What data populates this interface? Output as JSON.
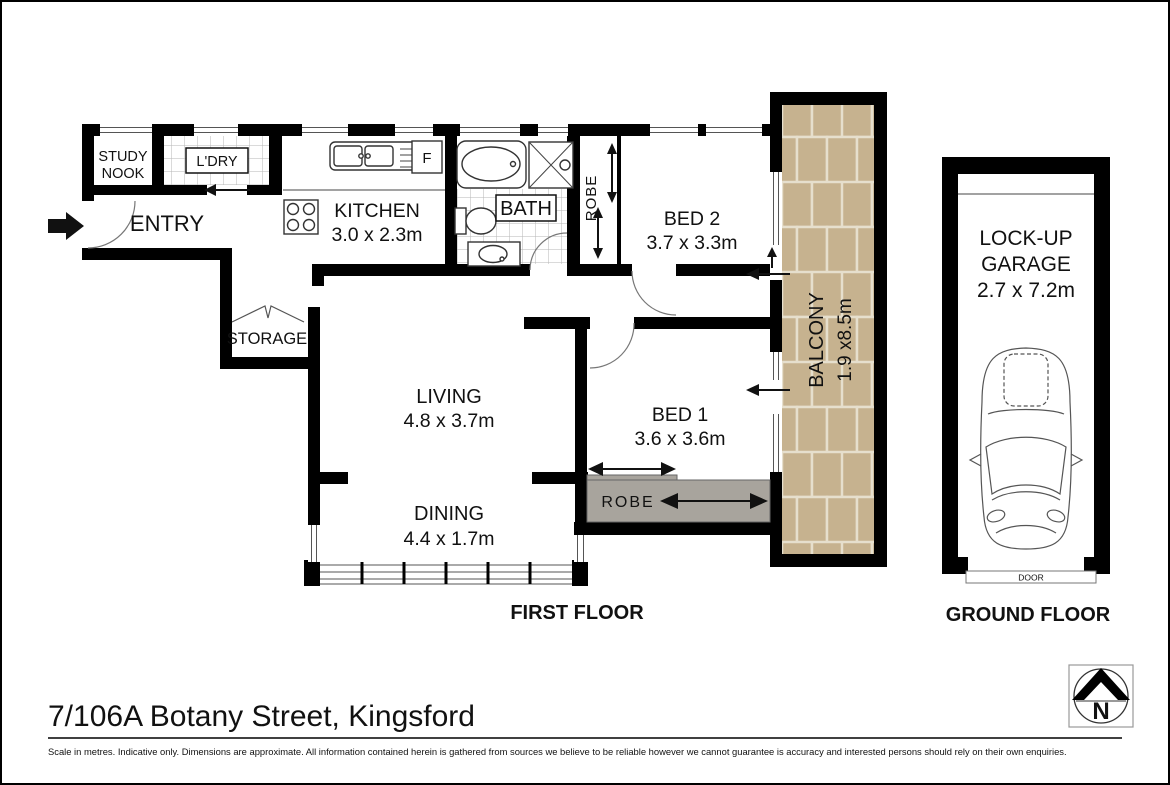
{
  "page": {
    "address": "7/106A Botany Street, Kingsford",
    "disclaimer": "Scale in metres. Indicative only. Dimensions are approximate. All information contained herein is gathered from sources we believe to be reliable however we cannot guarantee is accuracy and interested persons should rely on their own enquiries."
  },
  "colors": {
    "wall": "#000000",
    "robe_fill": "#a8a49d",
    "balcony_tile": "#cbb796",
    "balcony_grout": "#e6dfcd"
  },
  "first_floor": {
    "caption": "FIRST FLOOR",
    "rooms": {
      "study_nook": {
        "line1": "STUDY",
        "line2": "NOOK"
      },
      "laundry": {
        "label": "L'DRY"
      },
      "entry": {
        "label": "ENTRY"
      },
      "kitchen": {
        "label": "KITCHEN",
        "dims": "3.0 x 2.3m"
      },
      "fridge": {
        "label": "F"
      },
      "bath": {
        "label": "BATH"
      },
      "hall_robe": {
        "label": "ROBE"
      },
      "bed2": {
        "label": "BED 2",
        "dims": "3.7 x 3.3m"
      },
      "balcony": {
        "label": "BALCONY",
        "dims": "1.9 x8.5m"
      },
      "storage": {
        "label": "STORAGE"
      },
      "living": {
        "label": "LIVING",
        "dims": "4.8 x 3.7m"
      },
      "dining": {
        "label": "DINING",
        "dims": "4.4 x 1.7m"
      },
      "bed1": {
        "label": "BED 1",
        "dims": "3.6 x 3.6m"
      },
      "bed1_robe": {
        "label": "ROBE"
      }
    }
  },
  "ground_floor": {
    "caption": "GROUND FLOOR",
    "garage": {
      "line1": "LOCK-UP",
      "line2": "GARAGE",
      "dims": "2.7 x 7.2m"
    },
    "door_label": "DOOR"
  },
  "compass": {
    "north": "N"
  }
}
